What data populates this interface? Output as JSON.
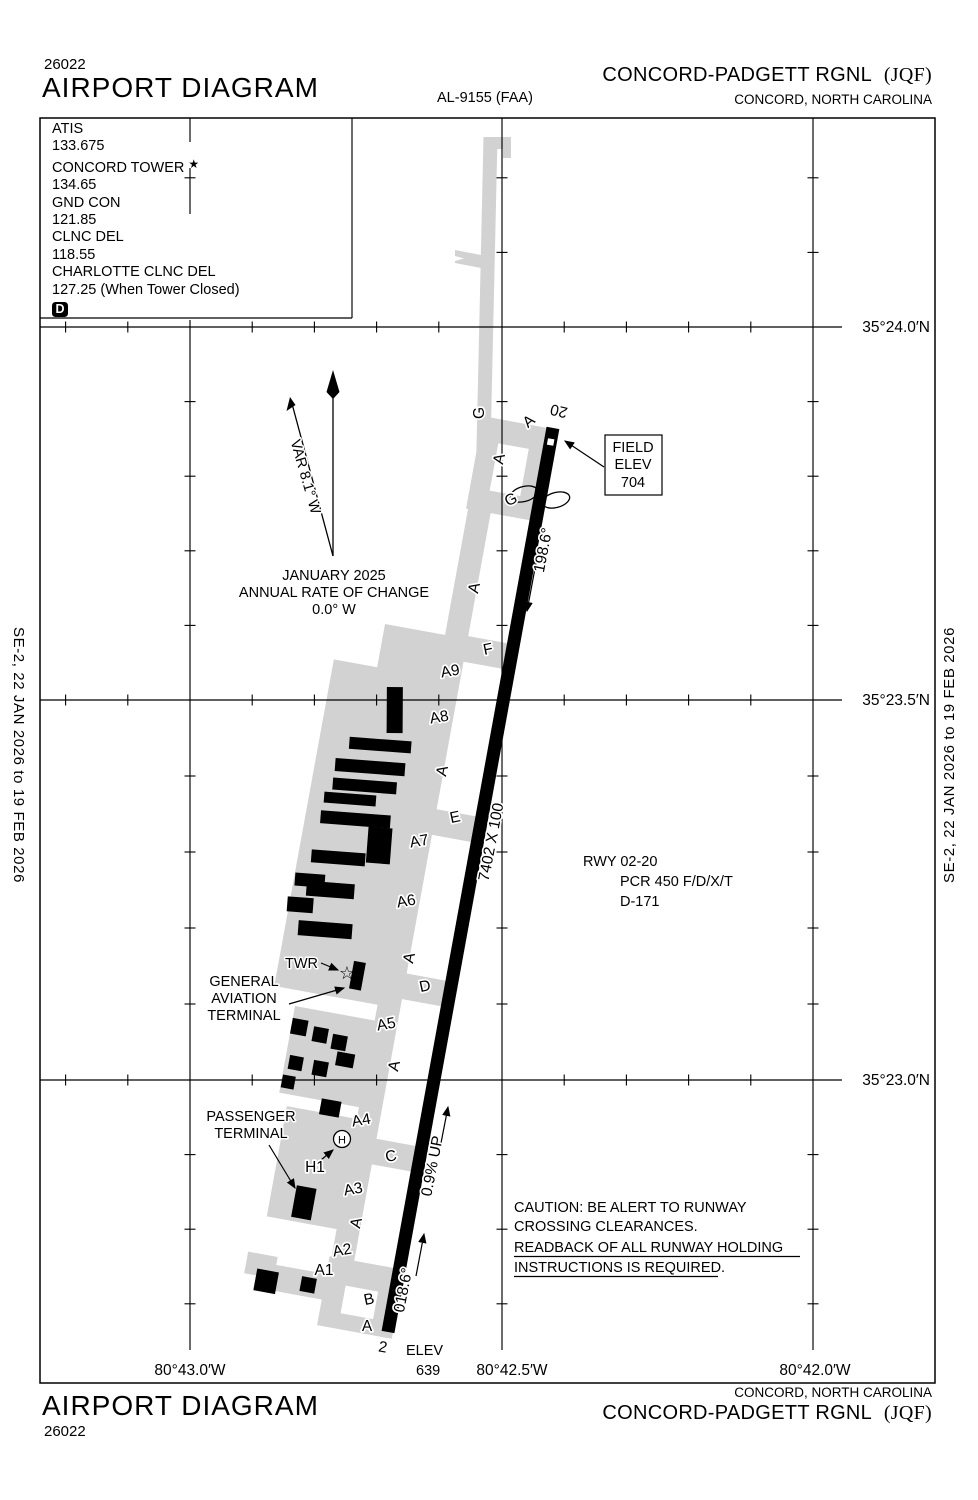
{
  "colors": {
    "pavement": "#d2d2d2",
    "ink": "#000000"
  },
  "margins": {
    "left_edition": "SE-2,  22 JAN 2026  to  19 FEB 2026",
    "right_edition": "SE-2,  22 JAN 2026  to  19 FEB 2026"
  },
  "header": {
    "chart_number": "26022",
    "title": "AIRPORT DIAGRAM",
    "procedure_code": "AL-9155 (FAA)",
    "airport_name": "CONCORD-PADGETT RGNL",
    "airport_icao": "(JQF)",
    "city": "CONCORD, NORTH CAROLINA"
  },
  "footer": {
    "title": "AIRPORT DIAGRAM",
    "chart_number": "26022",
    "airport_name": "CONCORD-PADGETT RGNL",
    "airport_icao": "(JQF)",
    "city": "CONCORD, NORTH CAROLINA"
  },
  "comm_box": {
    "atis_label": "ATIS",
    "atis": "133.675",
    "tower_label": "CONCORD TOWER",
    "tower_star": "★",
    "tower": "134.65",
    "gnd_label": "GND CON",
    "gnd": "121.85",
    "clnc_label": "CLNC DEL",
    "clnc": "118.55",
    "charlotte_label": "CHARLOTTE CLNC DEL",
    "charlotte": "127.25 (When Tower Closed)",
    "d_symbol": "D"
  },
  "grid": {
    "lat": [
      "35°24.0′N",
      "35°23.5′N",
      "35°23.0′N"
    ],
    "lon": [
      "80°43.0′W",
      "80°42.5′W",
      "80°42.0′W"
    ]
  },
  "north": {
    "var_label": "VAR 8.1° W",
    "epoch": "JANUARY 2025",
    "rate": "ANNUAL RATE OF CHANGE",
    "value": "0.0° W"
  },
  "field_elev": {
    "l1": "FIELD",
    "l2": "ELEV",
    "l3": "704"
  },
  "runway": {
    "num20": "20",
    "num2": "2",
    "hdg20": "198.6°",
    "hdg02": "018.6°",
    "dim": "7402 X 100",
    "slope": "0.9% UP",
    "elev_label": "ELEV",
    "elev": "639",
    "info1": "RWY 02-20",
    "info2": "PCR 450 F/D/X/T",
    "info3": "D-171"
  },
  "taxiways": {
    "a": "A",
    "a1": "A1",
    "a2": "A2",
    "a3": "A3",
    "a4": "A4",
    "a5": "A5",
    "a6": "A6",
    "a7": "A7",
    "a8": "A8",
    "a9": "A9",
    "b": "B",
    "c": "C",
    "d": "D",
    "e": "E",
    "f": "F",
    "g": "G",
    "h1": "H1",
    "helipad": "H"
  },
  "facilities": {
    "twr": "TWR",
    "tower_star": "☆",
    "ga1": "GENERAL",
    "ga2": "AVIATION",
    "ga3": "TERMINAL",
    "pax1": "PASSENGER",
    "pax2": "TERMINAL"
  },
  "caution": {
    "l1": "CAUTION: BE ALERT TO RUNWAY",
    "l2": "CROSSING CLEARANCES.",
    "l3": "READBACK OF ALL RUNWAY HOLDING",
    "l4": "INSTRUCTIONS IS REQUIRED."
  }
}
